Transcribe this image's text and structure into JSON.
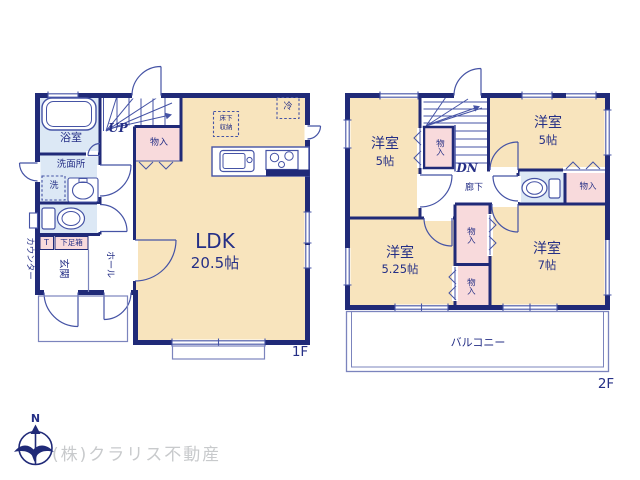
{
  "floor1": {
    "label": "1F",
    "bath": "浴室",
    "washroom": "洗面所",
    "washer": "洗",
    "stairs_up": "UP",
    "closet": "物入",
    "ldk_name": "LDK",
    "ldk_size": "20.5帖",
    "underfloor_line1": "床下",
    "underfloor_line2": "収納",
    "fridge": "冷",
    "counter": "カウンター",
    "shoe_t": "T",
    "shoe_box": "下足箱",
    "entrance": "玄関",
    "hall": "ホール"
  },
  "floor2": {
    "label": "2F",
    "stairs_down": "DN",
    "corridor": "廊下",
    "room_nw_name": "洋室",
    "room_nw_size": "5帖",
    "room_ne_name": "洋室",
    "room_ne_size": "5帖",
    "room_sw_name": "洋室",
    "room_sw_size": "5.25帖",
    "room_se_name": "洋室",
    "room_se_size": "7帖",
    "closet_stairs": "物入",
    "closet_ne": "物入",
    "closet_mid_upper": "物入",
    "closet_mid_lower": "物入",
    "balcony": "バルコニー"
  },
  "footer": {
    "company": "(株)クラリス不動産",
    "compass_north": "N"
  },
  "colors": {
    "wall": "#202a78",
    "room": "#f8e4bd",
    "closet": "#f8dadc",
    "wet": "#dce8f5",
    "line": "#4553a5",
    "text": "#252f86",
    "porch": "#7b84bd",
    "company": "#c8cacc"
  }
}
